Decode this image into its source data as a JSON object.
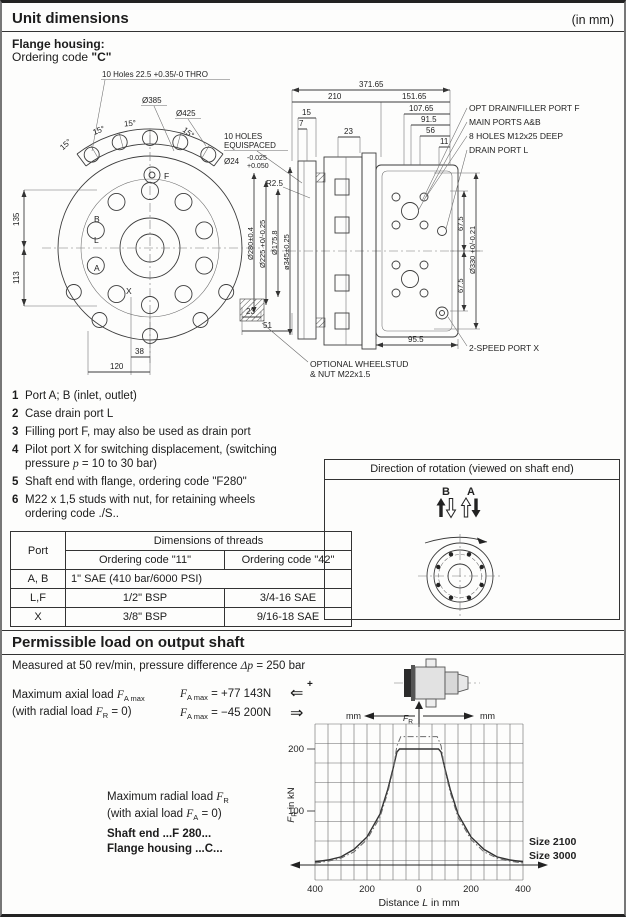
{
  "header": {
    "title": "Unit dimensions",
    "unit": "(in mm)"
  },
  "flange": {
    "line1": "Flange housing:",
    "line2_prefix": "Ordering code ",
    "line2_code": "\"C\""
  },
  "left_view": {
    "callout_holes": "10 Holes 22.5 +0.35/-0 THRO",
    "d385": "Ø385",
    "d425": "Ø425",
    "angles": [
      "15°",
      "15°",
      "15°",
      "15°"
    ],
    "equispaced1": "10 HOLES",
    "equispaced2": "EQUISPACED",
    "d24": "Ø24",
    "tol_minus": "-0.025",
    "tol_plus": "+0.050",
    "r25": "R2.5",
    "dim135": "135",
    "dim113": "113",
    "dim38": "38",
    "dim120": "120",
    "port_f": "F",
    "port_b": "B",
    "port_l": "L",
    "port_a": "A",
    "port_x": "X",
    "d280": "Ø280±0.4",
    "d225": "Ø225 +0/-0.25",
    "d175": "Ø175.8",
    "dim23": "23",
    "dim51": "51"
  },
  "right_view": {
    "dim371": "371.65",
    "dim210": "210",
    "dim151": "151.65",
    "dim107": "107.65",
    "dim91": "91.5",
    "dim56": "56",
    "dim11": "11",
    "dim15": "15",
    "dim7": "7",
    "dim23": "23",
    "dim345": "ø345±0.25",
    "dim67a": "67.5",
    "dim67b": "67.5",
    "d330": "Ø330 +0/-0.21",
    "dim95": "95.5",
    "lbl_optf": "OPT DRAIN/FILLER PORT F",
    "lbl_mainports": "MAIN PORTS A&B",
    "lbl_8holes": "8 HOLES M12x25 DEEP",
    "lbl_drain": "DRAIN PORT L",
    "lbl_2speed": "2-SPEED PORT X",
    "lbl_wheelstud1": "OPTIONAL WHEELSTUD",
    "lbl_wheelstud2": "& NUT M22x1.5"
  },
  "notes": {
    "n1": {
      "num": "1",
      "text": "Port A; B (inlet, outlet)"
    },
    "n2": {
      "num": "2",
      "text": "Case drain port  L"
    },
    "n3": {
      "num": "3",
      "text": "Filling port F, may also be used as drain port"
    },
    "n4": {
      "num": "4",
      "text": "Pilot port X for switching displacement,  (switching",
      "l2a": "pressure ",
      "l2b": "p",
      "l2c": " = 10 to 30 bar)"
    },
    "n5": {
      "num": "5",
      "text": "Shaft end with flange, ordering code \"F280\""
    },
    "n6": {
      "num": "6",
      "text": "M22  x  1,5  studs  with  nut,  for  retaining  wheels",
      "l2": "ordering code ./S.."
    }
  },
  "table": {
    "col_port": "Port",
    "col_threads": "Dimensions of threads",
    "col_code11": "Ordering code \"11\"",
    "col_code42": "Ordering code \"42\"",
    "rows": [
      {
        "port": "A, B",
        "c11": "1\" SAE (410 bar/6000 PSI)",
        "c42": ""
      },
      {
        "port": "L,F",
        "c11": "1/2\" BSP",
        "c42": "3/4-16 SAE"
      },
      {
        "port": "X",
        "c11": "3/8\" BSP",
        "c42": "9/16-18 SAE"
      }
    ]
  },
  "rotation_box": {
    "title": "Direction of rotation (viewed on shaft end)",
    "label_b": "B",
    "label_a": "A"
  },
  "section2": {
    "title": "Permissible load on output shaft",
    "measured_pre": "Measured at 50 rev/min, pressure difference ",
    "measured_it": "Δp",
    "measured_post": " = 250 bar"
  },
  "axial": {
    "l1a": "Maximum axial load ",
    "f": "F",
    "sub_amax": "A max",
    "l2a": "(with radial load ",
    "sub_r": "R",
    "l2b": " = 0)",
    "eq1": " = +77 143N",
    "eq2": " = −45 200N",
    "arrow_left": "⇐",
    "arrow_right": "⇒",
    "plus": "+"
  },
  "radial": {
    "l1a": "Maximum radial load ",
    "f": "F",
    "sub_r": "R",
    "l2a": "(with axial load ",
    "sub_a": "A",
    "l2b": " = 0)",
    "shaft": "Shaft end ...F 280...",
    "flange": "Flange housing ...C..."
  },
  "chart_data": {
    "type": "line",
    "title": "",
    "xlabel": "Distance L in mm",
    "xlabel_parts": [
      "Distance ",
      "L",
      " in mm"
    ],
    "ylabel": "FR in kN",
    "ylabel_f": "F",
    "ylabel_sub": "R",
    "ylabel_rest": " in kN",
    "xlim": [
      -400,
      400
    ],
    "ylim": [
      0,
      240
    ],
    "grid": true,
    "legend_position": "right",
    "x_ticks": [
      "400",
      "200",
      "0",
      "200",
      "400"
    ],
    "x_tick_values": [
      -400,
      -200,
      0,
      200,
      400
    ],
    "y_ticks": [
      "200",
      "100"
    ],
    "axis_unit_left": "mm",
    "axis_unit_right": "mm",
    "fr_f": "F",
    "fr_sub": "R",
    "series": [
      {
        "name": "Size 2100",
        "style": "solid",
        "x": [
          -400,
          -350,
          -300,
          -250,
          -200,
          -150,
          -120,
          -100,
          -85,
          -75,
          75,
          85,
          100,
          120,
          150,
          200,
          250,
          300,
          350,
          400
        ],
        "y": [
          18,
          21,
          26,
          38,
          58,
          95,
          135,
          168,
          195,
          200,
          200,
          195,
          168,
          135,
          95,
          58,
          38,
          26,
          21,
          18
        ]
      },
      {
        "name": "Size 3000",
        "style": "dashdot",
        "x": [
          -400,
          -350,
          -300,
          -250,
          -200,
          -150,
          -120,
          -100,
          -85,
          -70,
          70,
          85,
          100,
          120,
          150,
          200,
          250,
          300,
          350,
          400
        ],
        "y": [
          16,
          19,
          24,
          34,
          54,
          90,
          130,
          165,
          205,
          220,
          220,
          205,
          165,
          130,
          90,
          54,
          34,
          24,
          19,
          16
        ]
      }
    ]
  }
}
